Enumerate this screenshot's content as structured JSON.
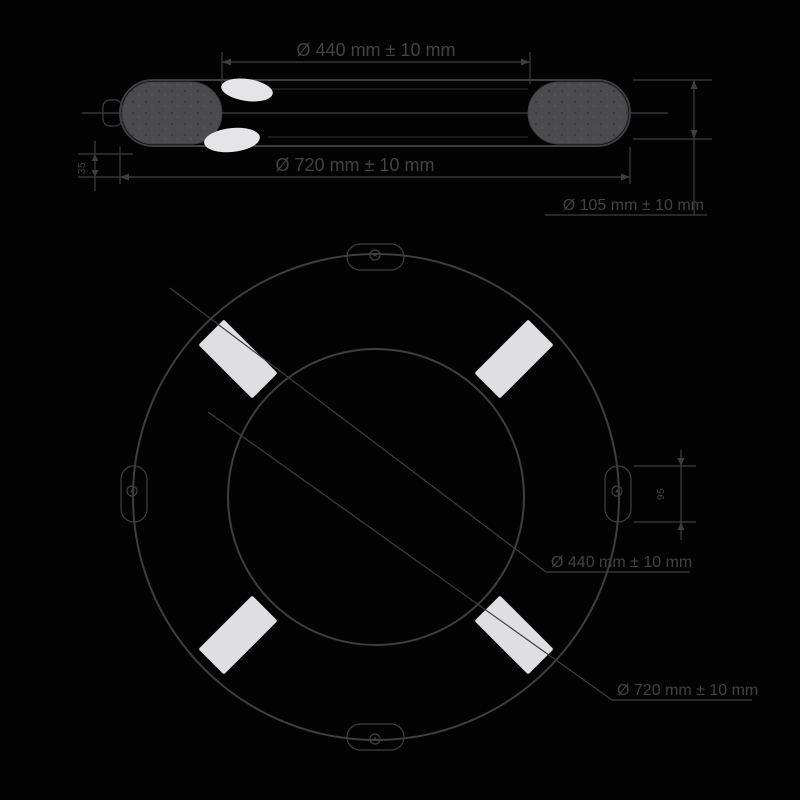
{
  "side_view": {
    "inner_diameter_label": "Ø 440 mm ± 10 mm",
    "outer_diameter_label": "Ø 720 mm ± 10 mm",
    "tube_diameter_label": "Ø 105 mm ± 10 mm",
    "band_width_label": "35"
  },
  "top_view": {
    "inner_diameter_label": "Ø 440 mm ± 10 mm",
    "outer_diameter_label": "Ø 720 mm ± 10 mm",
    "ear_width_label": "95"
  },
  "colors": {
    "background": "#030303",
    "line": "#3e3e41",
    "text": "#424245",
    "reflective_tape": "#dfdfe2",
    "reflector_highlight": "#e5e5e7",
    "end_cap": "#4b4b4e"
  }
}
